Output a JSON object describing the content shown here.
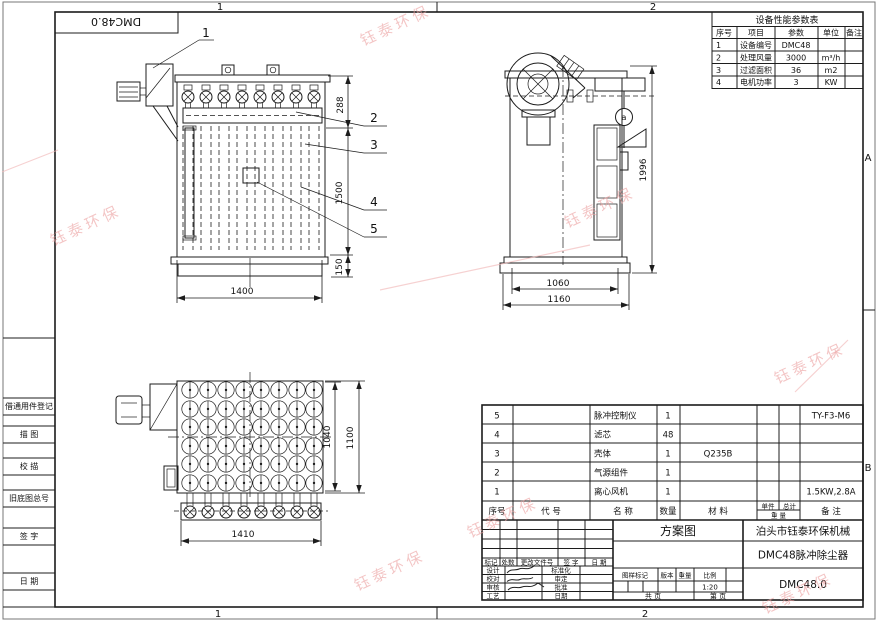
{
  "sheet": {
    "zone_top": [
      "1",
      "2"
    ],
    "zone_bottom": [
      "1",
      "2"
    ],
    "zone_right": [
      "A",
      "B"
    ],
    "corner_code": "DMC48.0"
  },
  "sidebar": {
    "labels": [
      "借通用件登记",
      "描 图",
      "校 描",
      "旧底图总号",
      "签 字",
      "日 期"
    ]
  },
  "perf_table": {
    "title": "设备性能参数表",
    "headers": [
      "序号",
      "项目",
      "参数",
      "单位",
      "备注"
    ],
    "rows": [
      {
        "no": "1",
        "item": "设备编号",
        "value": "DMC48",
        "unit": "",
        "note": ""
      },
      {
        "no": "2",
        "item": "处理风量",
        "value": "3000",
        "unit": "m³/h",
        "note": ""
      },
      {
        "no": "3",
        "item": "过滤面积",
        "value": "36",
        "unit": "m2",
        "note": ""
      },
      {
        "no": "4",
        "item": "电机功率",
        "value": "3",
        "unit": "KW",
        "note": ""
      }
    ]
  },
  "bom": {
    "headers": {
      "seq": "序号",
      "code": "代  号",
      "name": "名  称",
      "qty": "数量",
      "material": "材  料",
      "unit_w": "单件",
      "total_w": "总计",
      "weight": "重 量",
      "note": "备  注"
    },
    "rows": [
      {
        "seq": "5",
        "code": "",
        "name": "脉冲控制仪",
        "qty": "1",
        "material": "",
        "note": "TY-F3-M6"
      },
      {
        "seq": "4",
        "code": "",
        "name": "滤芯",
        "qty": "48",
        "material": "",
        "note": ""
      },
      {
        "seq": "3",
        "code": "",
        "name": "壳体",
        "qty": "1",
        "material": "Q235B",
        "note": ""
      },
      {
        "seq": "2",
        "code": "",
        "name": "气源组件",
        "qty": "1",
        "material": "",
        "note": ""
      },
      {
        "seq": "1",
        "code": "",
        "name": "离心风机",
        "qty": "1",
        "material": "",
        "note": "1.5KW,2.8A"
      }
    ]
  },
  "titleblock": {
    "scheme": "方案图",
    "company": "泊头市钰泰环保机械",
    "product": "DMC48脉冲除尘器",
    "code": "DMC48.0",
    "rev_headers": [
      "标记",
      "处数",
      "更改文件号",
      "签 字",
      "日 期"
    ],
    "sign_left": [
      "设计",
      "校对",
      "审核",
      "工艺"
    ],
    "sign_mid": [
      "标准化",
      "审定",
      "批准",
      "日期"
    ],
    "meta_headers": [
      "图样标记",
      "版本",
      "重量",
      "比例"
    ],
    "scale": "1:20",
    "pages_total": "共  页",
    "pages_num": "第  页"
  },
  "front_view": {
    "dim_top": "288",
    "dim_body": "1500",
    "dim_base": "150",
    "dim_width": "1400",
    "callouts": [
      "1",
      "2",
      "3",
      "4",
      "5"
    ]
  },
  "side_view": {
    "dim_height": "1996",
    "dim_inner": "1060",
    "dim_outer": "1160",
    "detail": "a"
  },
  "top_view": {
    "dim_grid": "1040",
    "dim_depth": "1100",
    "dim_width": "1410"
  },
  "watermark": {
    "text": "钰泰环保",
    "color": "#ec9f9f"
  }
}
